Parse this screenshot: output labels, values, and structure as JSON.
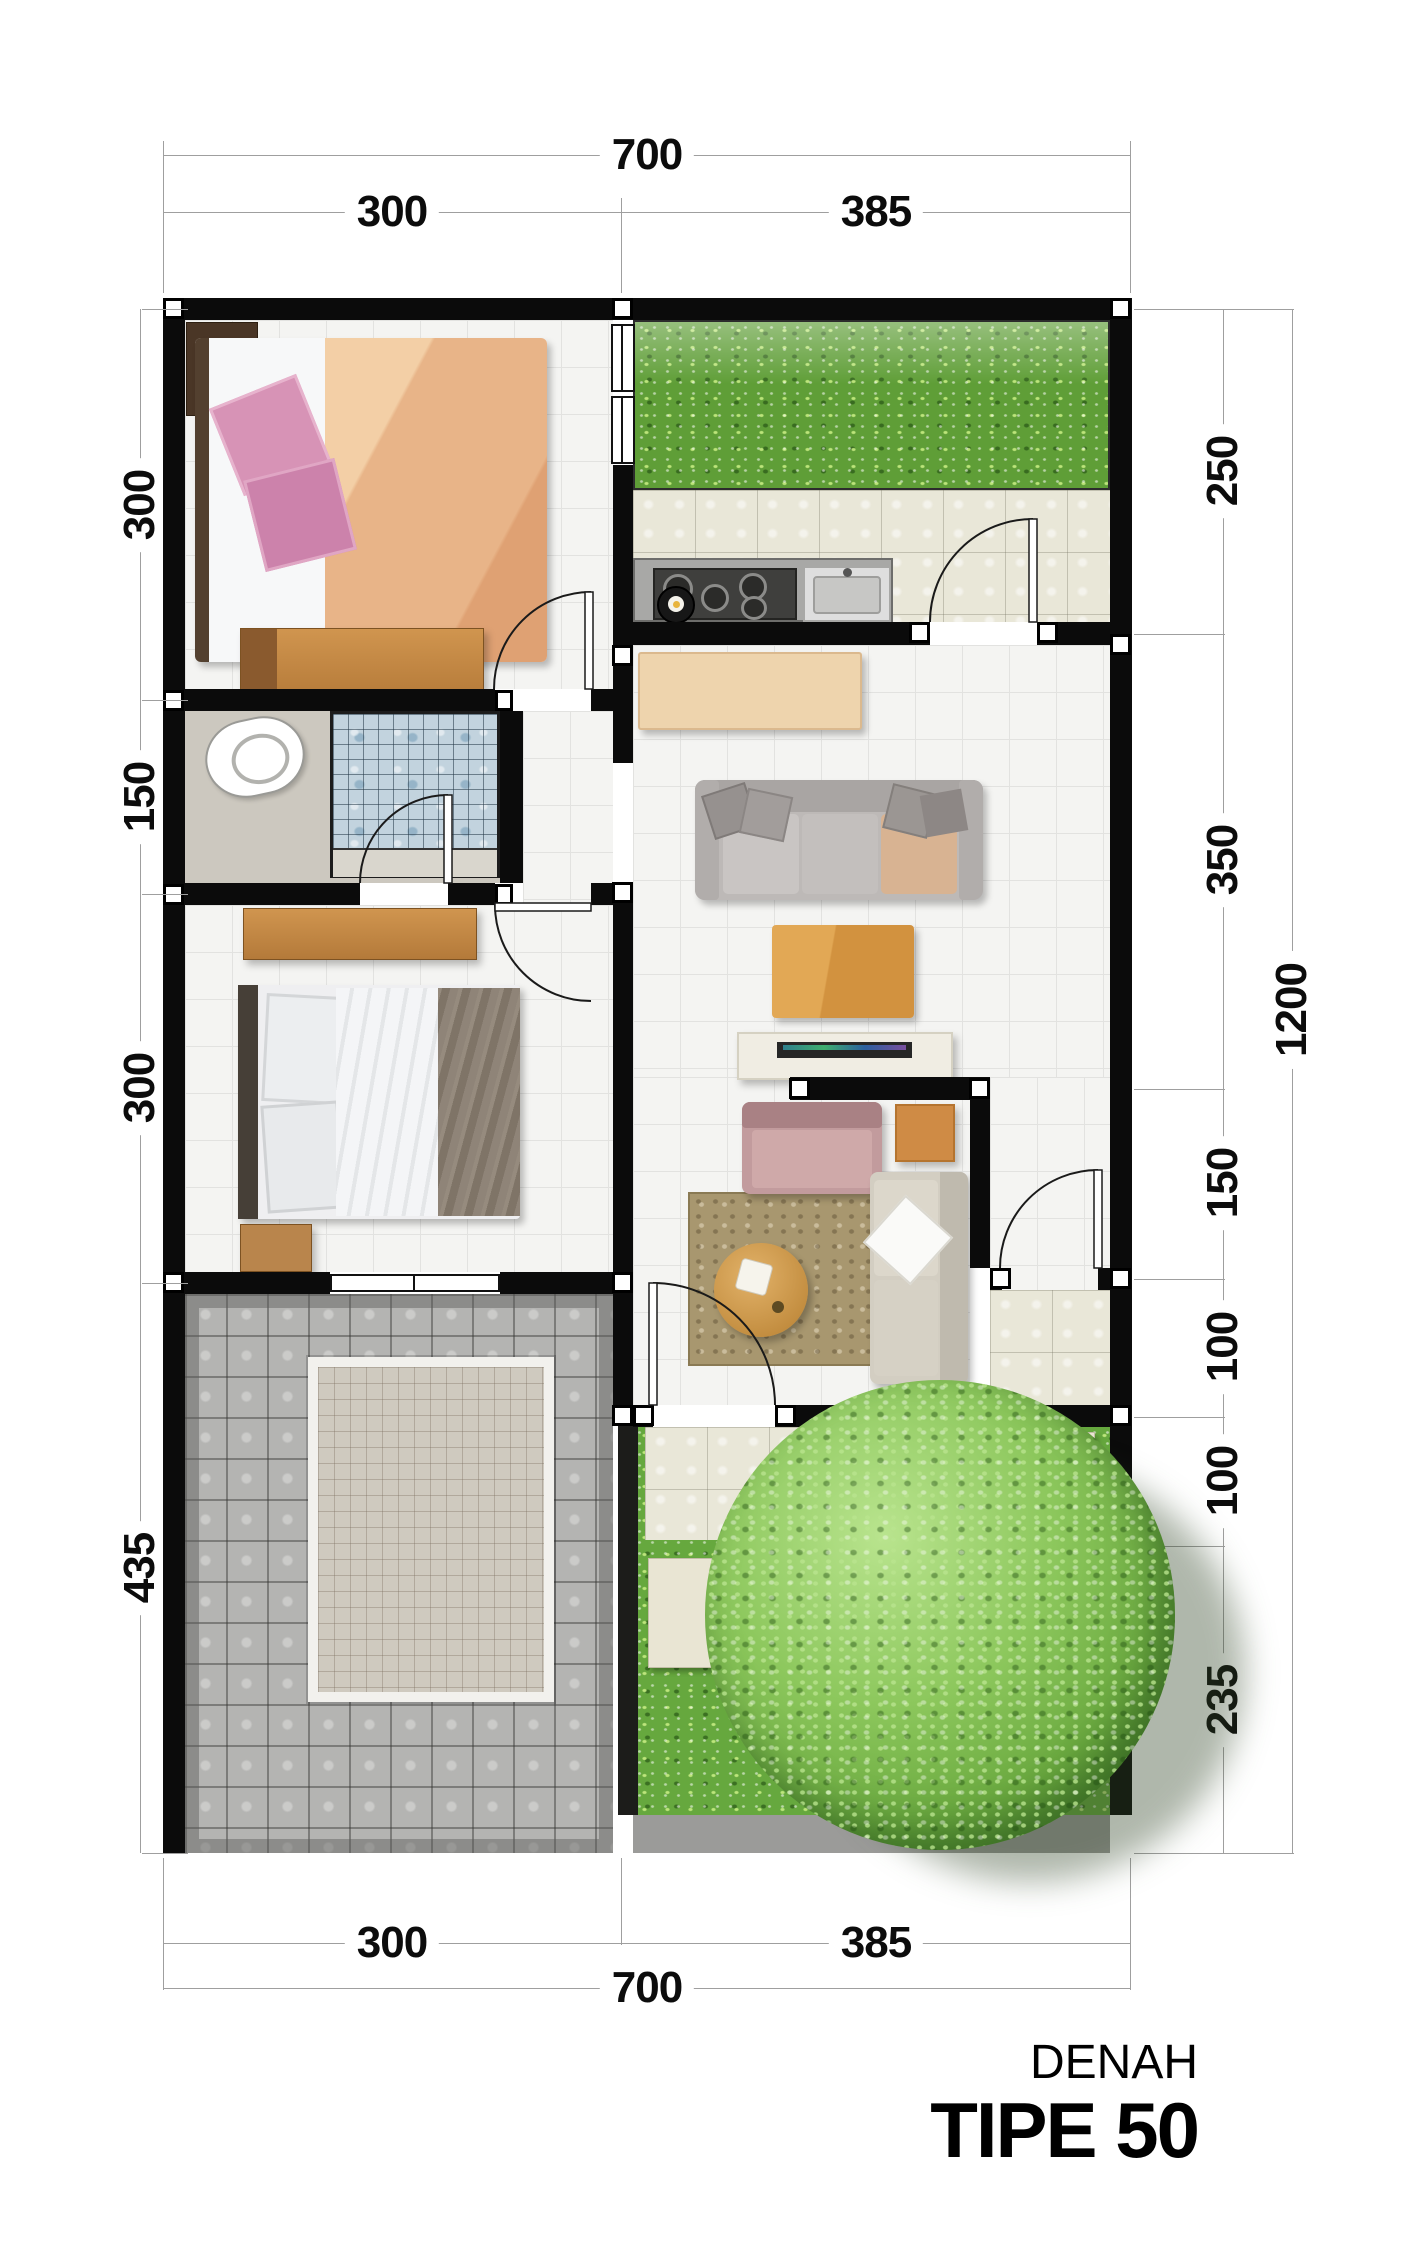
{
  "title": {
    "line1": "DENAH",
    "line2": "TIPE 50"
  },
  "dimensions": {
    "top": {
      "total": "700",
      "segments": [
        "300",
        "385"
      ]
    },
    "bottom": {
      "total": "700",
      "segments": [
        "300",
        "385"
      ]
    },
    "left": {
      "segments": [
        "300",
        "150",
        "300",
        "435"
      ]
    },
    "right": {
      "total": "1200",
      "segments": [
        "250",
        "350",
        "150",
        "100",
        "100",
        "235"
      ]
    }
  },
  "palette": {
    "wall": "#0b0b0b",
    "floor_tile": "#f4f4f2",
    "kitchen_tile": "#e9e7d8",
    "grass": "#5f9e37",
    "tree": "#6fae43",
    "mosaic_blue": "#c2d3de",
    "cobblestone": "#b4b4b2",
    "stepping_stone": "#e9e5d3",
    "wood": "#c08a4a",
    "bed_blanket_peach": "#e8b488",
    "pillow_pink": "#d793b6",
    "sofa_gray": "#bdb9b7",
    "coffee_table_wood": "#d79a44",
    "dimension_text": "#0c0c0c"
  }
}
